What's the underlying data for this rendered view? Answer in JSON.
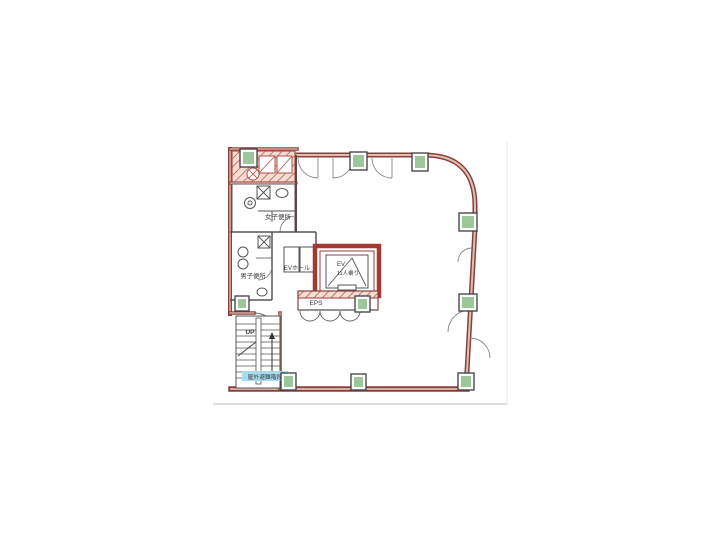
{
  "floorplan": {
    "type": "building-floor-plan",
    "labels": {
      "womens_toilet": "女子便所",
      "mens_toilet": "男子便所",
      "ev_hall": "EVホール",
      "elevator": "EV",
      "elevator_capacity": "11人乗り",
      "eps": "EPS",
      "stairs_up": "UP",
      "escape_stairs": "屋外避難階段"
    },
    "colors": {
      "outer_wall": "#8a4038",
      "wall_core": "#dcc0b6",
      "shaft_wall": "#a03a32",
      "hatch_bg": "#f5ddd6",
      "hatch_stripe": "#c4766b",
      "column_fill": "#9cc79a",
      "interior_line": "#4a4a4a",
      "highlight_bg": "#a8dcec",
      "highlight_text": "#1d3f9e",
      "page_edge": "#dedede"
    }
  }
}
